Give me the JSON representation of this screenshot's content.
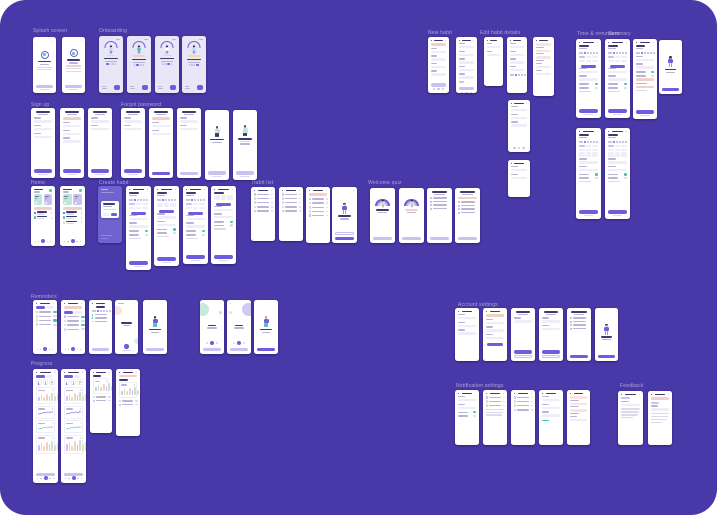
{
  "canvas": {
    "bg": "#4939a8",
    "page_bg": "#ffffff",
    "radius": 26
  },
  "palette": {
    "purple": "#6e5ddd",
    "purpleDeep": "#5b4bd1",
    "lavender": "#c9c1f0",
    "lavBg": "#e9e6f8",
    "modalBg": "#7063cf",
    "ink": "#3f3a6d",
    "gray": "#ddd9ea",
    "grayD": "#b9b4d6",
    "pink": "#f2cfc9",
    "pinkL": "#f9e4e0",
    "mint": "#bfe5d9",
    "teal": "#4fc2b4",
    "yellow": "#f4d9a0",
    "blue": "#c4dcf6",
    "peach": "#f3cdb9",
    "skin": "#e8b49c",
    "line": "#efedf7"
  },
  "labels": [
    {
      "text": "Splash screen",
      "x": 33,
      "y": 29
    },
    {
      "text": "Onboarding",
      "x": 99,
      "y": 29
    },
    {
      "text": "New habit",
      "x": 428,
      "y": 31
    },
    {
      "text": "Edit habit details",
      "x": 480,
      "y": 31
    },
    {
      "text": "Time & reminders",
      "x": 577,
      "y": 32
    },
    {
      "text": "Summary",
      "x": 608,
      "y": 32
    },
    {
      "text": "Sign up",
      "x": 31,
      "y": 103
    },
    {
      "text": "Forgot password",
      "x": 121,
      "y": 103
    },
    {
      "text": "Home",
      "x": 31,
      "y": 181
    },
    {
      "text": "Create habit",
      "x": 99,
      "y": 181
    },
    {
      "text": "Habit list",
      "x": 252,
      "y": 181
    },
    {
      "text": "Welcome quiz",
      "x": 368,
      "y": 181
    },
    {
      "text": "Reminders",
      "x": 31,
      "y": 295
    },
    {
      "text": "Progress",
      "x": 31,
      "y": 362
    },
    {
      "text": "Account settings",
      "x": 458,
      "y": 303
    },
    {
      "text": "Notification settings",
      "x": 456,
      "y": 384
    },
    {
      "text": "Feedback",
      "x": 620,
      "y": 384
    }
  ],
  "screens": [
    {
      "n": "splash-1",
      "k": "splash",
      "x": 33,
      "y": 37,
      "w": 23,
      "h": 56,
      "v": {}
    },
    {
      "n": "splash-2",
      "k": "splash",
      "x": 62,
      "y": 37,
      "w": 23,
      "h": 56,
      "v": {
        "pink": 1
      }
    },
    {
      "n": "onboarding-1",
      "k": "onboard",
      "x": 99,
      "y": 36,
      "w": 24,
      "h": 57,
      "v": {
        "step": 0
      }
    },
    {
      "n": "onboarding-2",
      "k": "onboard",
      "x": 127,
      "y": 36,
      "w": 24,
      "h": 57,
      "v": {
        "step": 1,
        "pill": "pink"
      }
    },
    {
      "n": "onboarding-3",
      "k": "onboard",
      "x": 155,
      "y": 36,
      "w": 24,
      "h": 57,
      "v": {
        "step": 2
      }
    },
    {
      "n": "onboarding-4",
      "k": "onboard",
      "x": 182,
      "y": 36,
      "w": 24,
      "h": 57,
      "v": {
        "step": 3,
        "pill": "yellow"
      }
    },
    {
      "n": "new-habit-1",
      "k": "form",
      "x": 428,
      "y": 37,
      "w": 21,
      "h": 56,
      "v": {
        "pink": 1,
        "fields": 4,
        "btn": "lav",
        "icons": 1
      }
    },
    {
      "n": "new-habit-2",
      "k": "form",
      "x": 456,
      "y": 37,
      "w": 21,
      "h": 56,
      "v": {
        "fields": 5,
        "chip": 1,
        "btn": "lav",
        "icons": 1
      }
    },
    {
      "n": "new-habit-3",
      "k": "form",
      "x": 484,
      "y": 37,
      "w": 19,
      "h": 49,
      "v": {
        "fields": 2
      }
    },
    {
      "n": "edit-habit-1",
      "k": "form",
      "x": 507,
      "y": 37,
      "w": 20,
      "h": 56,
      "v": {
        "fields": 4,
        "circles": 1
      }
    },
    {
      "n": "edit-habit-2",
      "k": "form",
      "x": 533,
      "y": 37,
      "w": 21,
      "h": 59,
      "v": {
        "pinkRows": 1,
        "fields": 2
      }
    },
    {
      "n": "edit-habit-3",
      "k": "form",
      "x": 508,
      "y": 100,
      "w": 22,
      "h": 52,
      "v": {
        "fields": 3,
        "icons": 1
      }
    },
    {
      "n": "edit-habit-4",
      "k": "form",
      "x": 508,
      "y": 160,
      "w": 22,
      "h": 37,
      "v": {
        "fields": 2
      }
    },
    {
      "n": "time-reminders-1",
      "k": "tallform",
      "x": 576,
      "y": 39,
      "w": 25,
      "h": 79,
      "v": {
        "week": 1,
        "pills": 1,
        "btnMid": 1
      }
    },
    {
      "n": "time-reminders-2",
      "k": "tallform",
      "x": 605,
      "y": 39,
      "w": 25,
      "h": 79,
      "v": {
        "week": 1,
        "pills": 1,
        "btnMid": 1
      }
    },
    {
      "n": "summary-error",
      "k": "tallform",
      "x": 633,
      "y": 39,
      "w": 24,
      "h": 80,
      "v": {
        "week": 1,
        "pinkRows": 1
      }
    },
    {
      "n": "summary-done",
      "k": "illus",
      "x": 659,
      "y": 40,
      "w": 23,
      "h": 54,
      "v": {
        "btn": "purple",
        "hair": "#3c3357"
      }
    },
    {
      "n": "time-reminders-3",
      "k": "tallform",
      "x": 576,
      "y": 128,
      "w": 25,
      "h": 91,
      "v": {
        "week": 1,
        "pills": 1,
        "grid": 1
      }
    },
    {
      "n": "time-reminders-4",
      "k": "tallform",
      "x": 605,
      "y": 128,
      "w": 25,
      "h": 91,
      "v": {
        "week": 1,
        "pills": 1,
        "grid": 1
      }
    },
    {
      "n": "signup-1",
      "k": "form",
      "x": 31,
      "y": 108,
      "w": 24,
      "h": 70,
      "v": {
        "title": 1,
        "fields": 3,
        "btn": "purple",
        "foot": 1
      }
    },
    {
      "n": "signup-2",
      "k": "form",
      "x": 60,
      "y": 108,
      "w": 24,
      "h": 70,
      "v": {
        "title": 1,
        "pink": 1,
        "fields": 3,
        "btn": "purple",
        "foot": 1
      }
    },
    {
      "n": "signup-3",
      "k": "form",
      "x": 88,
      "y": 108,
      "w": 24,
      "h": 70,
      "v": {
        "title": 1,
        "fields": 2,
        "btn": "purple",
        "foot": 1
      }
    },
    {
      "n": "forgot-1",
      "k": "form",
      "x": 121,
      "y": 108,
      "w": 24,
      "h": 70,
      "v": {
        "title": 1,
        "fields": 2,
        "btn": "purple",
        "foot": 1
      }
    },
    {
      "n": "forgot-2",
      "k": "form",
      "x": 149,
      "y": 108,
      "w": 24,
      "h": 70,
      "v": {
        "title": 1,
        "pink": 1,
        "fields": 2,
        "btn": "purple"
      }
    },
    {
      "n": "forgot-3",
      "k": "form",
      "x": 177,
      "y": 108,
      "w": 24,
      "h": 70,
      "v": {
        "title": 1,
        "fields": 2,
        "btn": "lav"
      }
    },
    {
      "n": "forgot-success-1",
      "k": "success",
      "x": 205,
      "y": 110,
      "w": 24,
      "h": 70,
      "v": {}
    },
    {
      "n": "forgot-success-2",
      "k": "success",
      "x": 233,
      "y": 110,
      "w": 24,
      "h": 70,
      "v": {
        "pink": 1
      }
    },
    {
      "n": "home-1",
      "k": "home",
      "x": 31,
      "y": 186,
      "w": 24,
      "h": 60,
      "v": {
        "rows": 2
      }
    },
    {
      "n": "home-2",
      "k": "home",
      "x": 60,
      "y": 186,
      "w": 25,
      "h": 60,
      "v": {
        "rows": 3
      }
    },
    {
      "n": "create-habit-modal",
      "k": "modal",
      "x": 98,
      "y": 186,
      "w": 24,
      "h": 57,
      "v": {}
    },
    {
      "n": "create-habit-1",
      "k": "tallform",
      "x": 126,
      "y": 186,
      "w": 25,
      "h": 84,
      "v": {
        "week": 1,
        "pills": 1,
        "btnMid": 1,
        "pink": 1
      }
    },
    {
      "n": "create-habit-2",
      "k": "tallform",
      "x": 154,
      "y": 186,
      "w": 25,
      "h": 80,
      "v": {
        "week": 1,
        "grid": 1,
        "btnMid": 1
      }
    },
    {
      "n": "create-habit-3",
      "k": "tallform",
      "x": 183,
      "y": 186,
      "w": 25,
      "h": 78,
      "v": {
        "week": 1,
        "pills": 1,
        "btnMid": 1
      }
    },
    {
      "n": "create-habit-4",
      "k": "tallform",
      "x": 211,
      "y": 186,
      "w": 25,
      "h": 78,
      "v": {
        "grid": 1,
        "btnMid": 1
      }
    },
    {
      "n": "habit-list-1",
      "k": "list",
      "x": 251,
      "y": 187,
      "w": 24,
      "h": 54,
      "v": {
        "rows": 5
      }
    },
    {
      "n": "habit-list-2",
      "k": "list",
      "x": 279,
      "y": 187,
      "w": 24,
      "h": 54,
      "v": {
        "rows": 5
      }
    },
    {
      "n": "habit-list-3",
      "k": "list",
      "x": 306,
      "y": 187,
      "w": 24,
      "h": 56,
      "v": {
        "rows": 5,
        "pink": 1
      }
    },
    {
      "n": "habit-list-empty",
      "k": "illus",
      "x": 332,
      "y": 187,
      "w": 25,
      "h": 56,
      "v": {
        "btn": "purple",
        "ghost": 1,
        "close": 1
      }
    },
    {
      "n": "quiz-welcome-1",
      "k": "rainbow",
      "x": 370,
      "y": 188,
      "w": 25,
      "h": 55,
      "v": {}
    },
    {
      "n": "quiz-welcome-2",
      "k": "rainbow",
      "x": 399,
      "y": 188,
      "w": 25,
      "h": 55,
      "v": {
        "pink": 1
      }
    },
    {
      "n": "quiz-questions-1",
      "k": "questions",
      "x": 427,
      "y": 188,
      "w": 25,
      "h": 55,
      "v": {}
    },
    {
      "n": "quiz-questions-2",
      "k": "questions",
      "x": 455,
      "y": 188,
      "w": 25,
      "h": 55,
      "v": {
        "pink": 1
      }
    },
    {
      "n": "reminders-1",
      "k": "list",
      "x": 33,
      "y": 300,
      "w": 24,
      "h": 54,
      "v": {
        "seg": 1,
        "rows": 4,
        "toggles": 1,
        "nav": 1
      }
    },
    {
      "n": "reminders-2",
      "k": "list",
      "x": 61,
      "y": 300,
      "w": 24,
      "h": 54,
      "v": {
        "seg": 1,
        "rows": 4,
        "toggles": 1,
        "nav": 1,
        "pink": 1
      }
    },
    {
      "n": "reminders-schedule",
      "k": "schedule",
      "x": 89,
      "y": 300,
      "w": 23,
      "h": 54,
      "v": {}
    },
    {
      "n": "reminders-empty",
      "k": "empty",
      "x": 115,
      "y": 300,
      "w": 23,
      "h": 54,
      "v": {}
    },
    {
      "n": "reminders-illus",
      "k": "illus",
      "x": 143,
      "y": 300,
      "w": 24,
      "h": 54,
      "v": {
        "btn": "lav",
        "hair": "#2f2f46"
      }
    },
    {
      "n": "timer-1",
      "k": "timer",
      "x": 200,
      "y": 300,
      "w": 24,
      "h": 54,
      "v": {
        "side": "left"
      }
    },
    {
      "n": "timer-2",
      "k": "timer",
      "x": 227,
      "y": 300,
      "w": 24,
      "h": 54,
      "v": {
        "side": "right"
      }
    },
    {
      "n": "timer-done",
      "k": "illus",
      "x": 254,
      "y": 300,
      "w": 24,
      "h": 54,
      "v": {
        "btn": "purple",
        "hair": "#d78a8a"
      }
    },
    {
      "n": "progress-1",
      "k": "chartsTall",
      "x": 33,
      "y": 369,
      "w": 25,
      "h": 114,
      "v": {}
    },
    {
      "n": "progress-2",
      "k": "chartsTall",
      "x": 61,
      "y": 369,
      "w": 25,
      "h": 114,
      "v": {
        "alt": 1
      }
    },
    {
      "n": "progress-3",
      "k": "chartsShort",
      "x": 90,
      "y": 369,
      "w": 22,
      "h": 64,
      "v": {}
    },
    {
      "n": "progress-4",
      "k": "chartsShort",
      "x": 116,
      "y": 369,
      "w": 24,
      "h": 67,
      "v": {
        "pink": 1
      }
    },
    {
      "n": "account-1",
      "k": "form",
      "x": 455,
      "y": 308,
      "w": 24,
      "h": 53,
      "v": {
        "fields": 3
      }
    },
    {
      "n": "account-2",
      "k": "form",
      "x": 483,
      "y": 308,
      "w": 24,
      "h": 53,
      "v": {
        "pink": 1,
        "fields": 3,
        "btnMid": 1
      }
    },
    {
      "n": "account-3",
      "k": "form",
      "x": 511,
      "y": 308,
      "w": 24,
      "h": 53,
      "v": {
        "title": 1,
        "fields": 1,
        "btn": "purple",
        "ghost": 1
      }
    },
    {
      "n": "account-4",
      "k": "form",
      "x": 539,
      "y": 308,
      "w": 24,
      "h": 53,
      "v": {
        "title": 1,
        "fields": 2,
        "btn": "purple",
        "ghost": 1
      }
    },
    {
      "n": "account-5",
      "k": "questions",
      "x": 567,
      "y": 308,
      "w": 24,
      "h": 53,
      "v": {
        "btn": "purple"
      }
    },
    {
      "n": "account-done",
      "k": "illus",
      "x": 595,
      "y": 308,
      "w": 23,
      "h": 53,
      "v": {
        "btn": "purple"
      }
    },
    {
      "n": "notif-1",
      "k": "form",
      "x": 455,
      "y": 390,
      "w": 24,
      "h": 55,
      "v": {
        "fields": 2,
        "toggles": 1
      }
    },
    {
      "n": "notif-2",
      "k": "list",
      "x": 483,
      "y": 390,
      "w": 24,
      "h": 55,
      "v": {
        "rows": 3,
        "para": 1
      }
    },
    {
      "n": "notif-3",
      "k": "list",
      "x": 511,
      "y": 390,
      "w": 24,
      "h": 55,
      "v": {
        "rows": 4
      }
    },
    {
      "n": "notif-4",
      "k": "form",
      "x": 539,
      "y": 390,
      "w": 24,
      "h": 55,
      "v": {
        "fields": 3,
        "link": 1
      }
    },
    {
      "n": "notif-5",
      "k": "form",
      "x": 567,
      "y": 390,
      "w": 23,
      "h": 55,
      "v": {
        "pinkRows": 1,
        "fields": 1
      }
    },
    {
      "n": "feedback-1",
      "k": "para",
      "x": 618,
      "y": 391,
      "w": 25,
      "h": 54,
      "v": {}
    },
    {
      "n": "feedback-2",
      "k": "para",
      "x": 648,
      "y": 391,
      "w": 24,
      "h": 54,
      "v": {
        "pink": 1
      }
    }
  ]
}
